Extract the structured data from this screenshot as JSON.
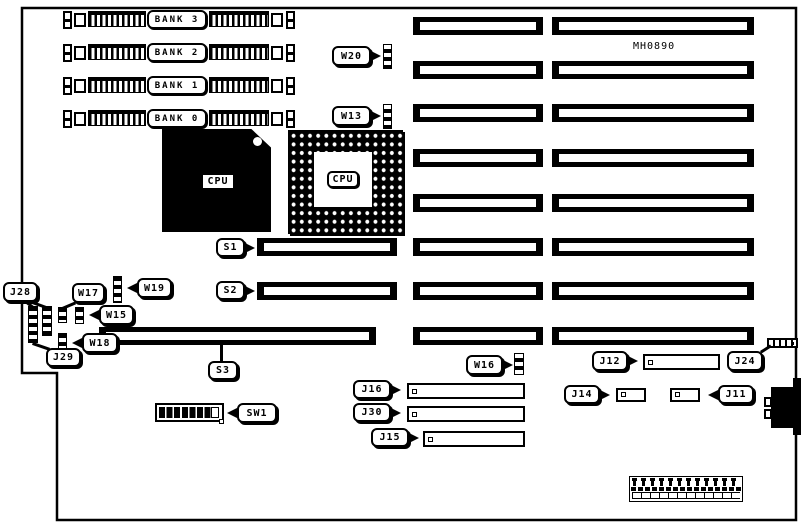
{
  "board": {
    "part_number": "MH0890",
    "background": "#ffffff",
    "ink": "#000000"
  },
  "memory_banks": [
    {
      "label": "BANK 3"
    },
    {
      "label": "BANK 2"
    },
    {
      "label": "BANK 1"
    },
    {
      "label": "BANK 0"
    }
  ],
  "cpu": {
    "chip_label": "CPU",
    "socket_label": "CPU"
  },
  "jumpers": {
    "w20": "W20",
    "w13": "W13",
    "w19": "W19",
    "w17": "W17",
    "w15": "W15",
    "w18": "W18",
    "w16": "W16"
  },
  "connectors": {
    "j28": "J28",
    "j29": "J29",
    "j16": "J16",
    "j30": "J30",
    "j15": "J15",
    "j12": "J12",
    "j24": "J24",
    "j14": "J14",
    "j11": "J11"
  },
  "switches": {
    "s1": "S1",
    "s2": "S2",
    "s3": "S3",
    "sw1": "SW1"
  }
}
